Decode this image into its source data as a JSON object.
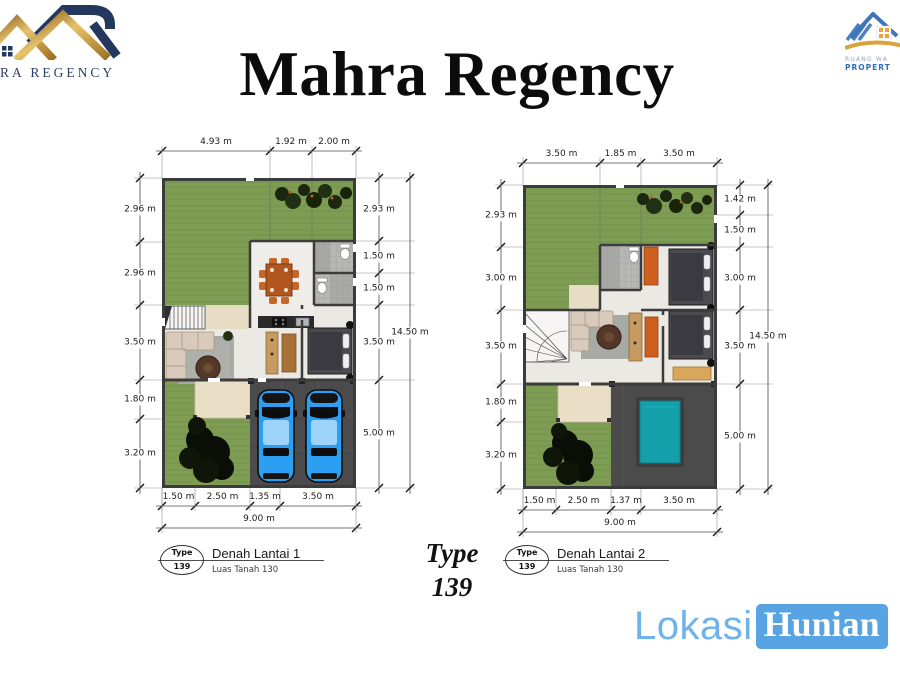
{
  "slide": {
    "title": "Mahra Regency"
  },
  "logo_left": {
    "caption": "RA REGENCY"
  },
  "logo_right": {
    "line1": "RUANG WA",
    "line2": "PROPERT"
  },
  "type_callout": {
    "line1": "Type",
    "line2": "139"
  },
  "footer_brand": {
    "part1": "Lokasi",
    "part2": "Hunian"
  },
  "plans": [
    {
      "label": {
        "badge_top": "Type",
        "badge_num": "139",
        "title": "Denah Lantai 1",
        "subtitle": "Luas Tanah 130"
      },
      "dims_top": [
        "4.93 m",
        "1.92 m",
        "2.00 m"
      ],
      "dims_left": [
        "2.96 m",
        "2.96 m",
        "3.50 m",
        "1.80 m",
        "3.20 m"
      ],
      "dims_right": [
        "2.93 m",
        "1.50 m",
        "1.50 m",
        "3.50 m",
        "5.00 m"
      ],
      "dims_right_total": "14.50 m",
      "dims_bottom": [
        "1.50 m",
        "2.50 m",
        "1.35 m",
        "3.50 m"
      ],
      "dims_bottom_total": "9.00 m"
    },
    {
      "label": {
        "badge_top": "Type",
        "badge_num": "139",
        "title": "Denah Lantai 2",
        "subtitle": "Luas Tanah 130"
      },
      "dims_top": [
        "3.50 m",
        "1.85 m",
        "3.50 m"
      ],
      "dims_left": [
        "2.93 m",
        "3.00 m",
        "3.50 m",
        "1.80 m",
        "3.20 m"
      ],
      "dims_right": [
        "1.42 m",
        "1.50 m",
        "3.00 m",
        "3.50 m",
        "5.00 m"
      ],
      "dims_right_total": "14.50 m",
      "dims_bottom": [
        "1.50 m",
        "2.50 m",
        "1.37 m",
        "3.50 m"
      ],
      "dims_bottom_total": "9.00 m"
    }
  ],
  "colors": {
    "navy": "#24385f",
    "gold": "#c99b3f",
    "grass": "#7e9d53",
    "wall": "#3c3c3c",
    "carport": "#4b4b4b",
    "car_blue": "#2b9ff2",
    "pool_teal": "#13a0ab",
    "brand_blue": "#57a3e3"
  }
}
